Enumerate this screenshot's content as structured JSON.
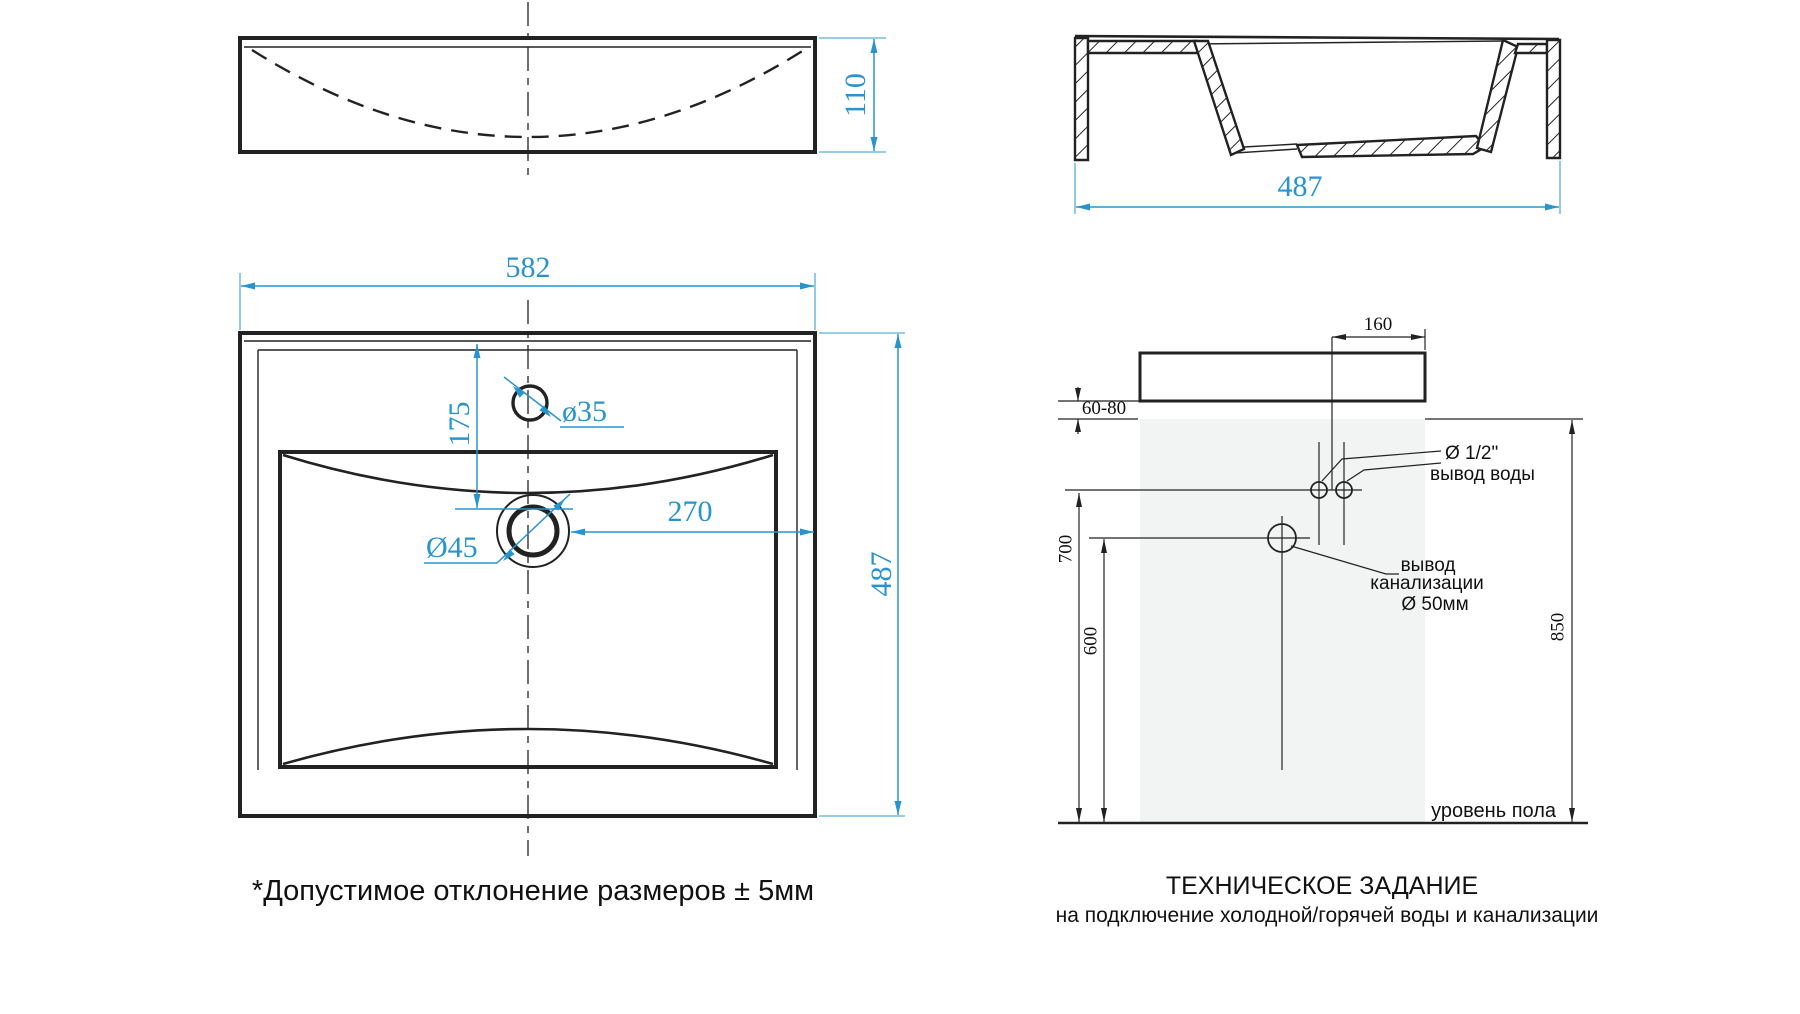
{
  "drawing": {
    "note": "*Допустимое отклонение размеров ± 5мм",
    "title_line1": "ТЕХНИЧЕСКОЕ ЗАДАНИЕ",
    "title_line2": "на подключение холодной/горячей воды и канализации",
    "floor_label": "уровень пола"
  },
  "front_view": {
    "height_dim": "110"
  },
  "section_view": {
    "width_dim": "487"
  },
  "plan_view": {
    "width_dim": "582",
    "depth_dim": "487",
    "faucet_offset_dim": "175",
    "drain_offset_dim": "270",
    "faucet_hole_dim": "ø35",
    "drain_hole_dim": "Ø45"
  },
  "installation": {
    "cabinet_width_dim": "160",
    "gap_dim": "60-80",
    "water_height_dim": "700",
    "drain_height_dim": "600",
    "total_height_dim": "850",
    "water_label_line1": "Ø 1/2\"",
    "water_label_line2": "вывод воды",
    "drain_label_line1": "вывод",
    "drain_label_line2": "канализации",
    "drain_label_line3": "Ø 50мм"
  },
  "colors": {
    "dimension_blue": "#2793cf",
    "extension_blue": "#5caed8",
    "line_black": "#222222",
    "cabinet_fill": "#e8eaea",
    "wall_fill": "#f2f3f3",
    "background": "#ffffff"
  }
}
